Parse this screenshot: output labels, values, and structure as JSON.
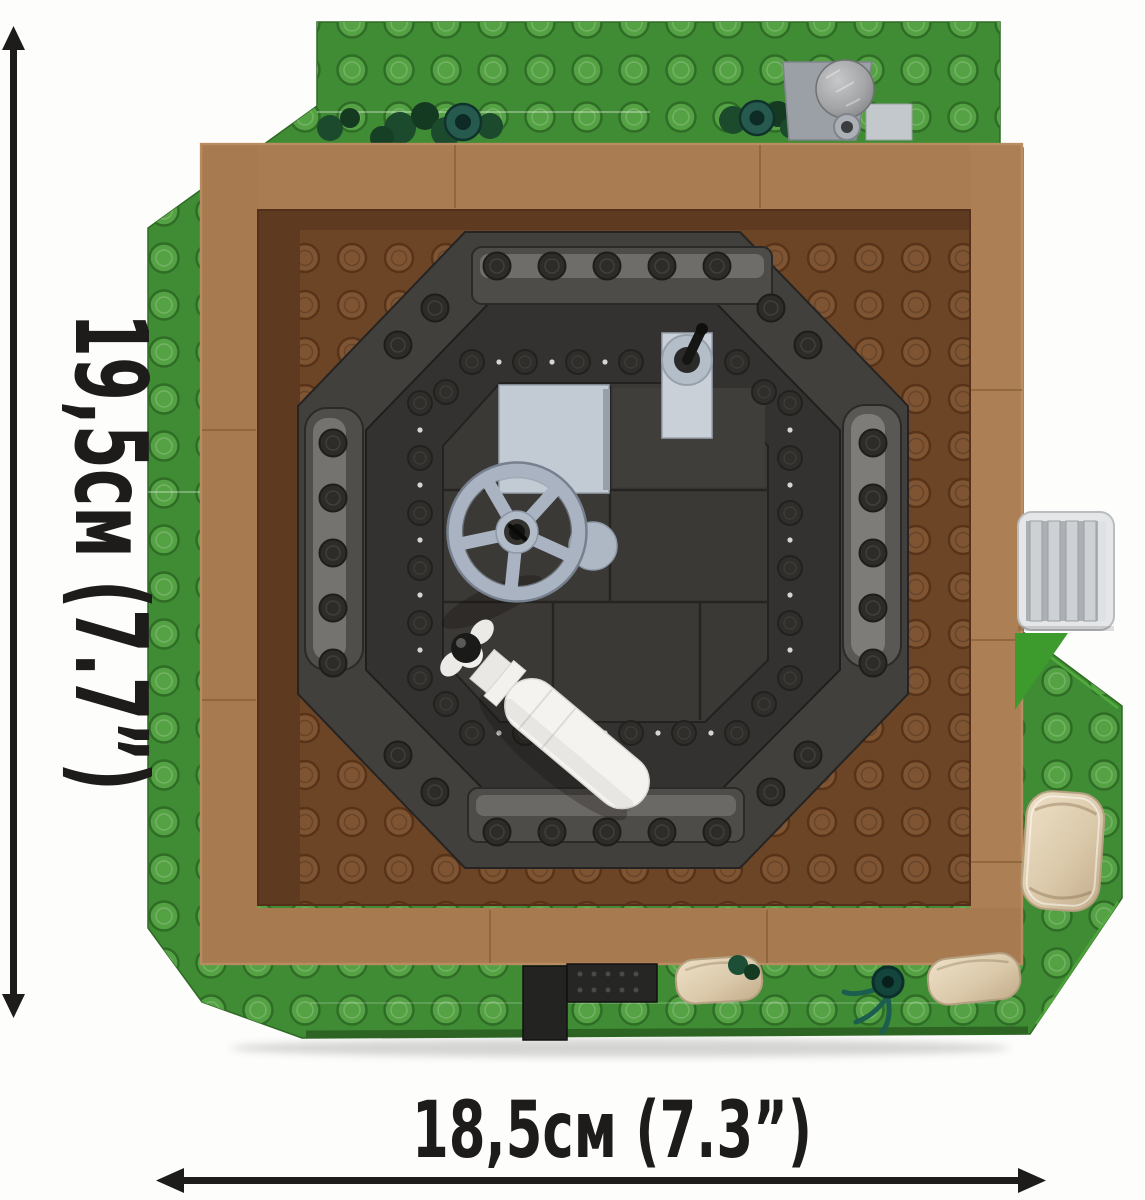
{
  "annotations": {
    "height_label": "19,5см (7.7”)",
    "width_label": "18,5см (7.3”)"
  },
  "colors": {
    "baseplate_green": "#3f8c34",
    "stud_green": "#55a244",
    "wall_tan_brown": "#aa7c51",
    "courtyard_brown": "#6c4527",
    "structure_dark_gray": "#42403c",
    "moat_dark": "#343230",
    "platform_dark": "#3b3936",
    "accent_light_gray": "#b7c0cb",
    "shell_white": "#f4f3ef",
    "sandbag_tan": "#ddcdb0",
    "foliage_dark_green": "#1c4a2d",
    "tree_teal": "#275a4f",
    "annotation_black": "#1d1c1a"
  }
}
